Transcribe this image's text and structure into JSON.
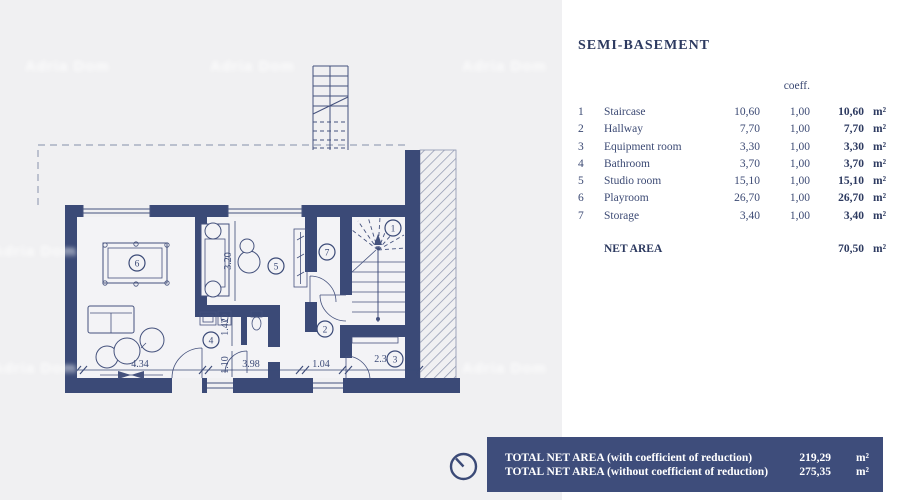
{
  "window": {
    "background_left": "#f0f0f2",
    "background_right": "#ffffff"
  },
  "header": {
    "title": "SEMI-BASEMENT"
  },
  "table": {
    "coeff_header": "coeff.",
    "rows": [
      {
        "num": "1",
        "name": "Staircase",
        "area": "10,60",
        "coeff": "1,00",
        "total": "10,60",
        "unit": "m²"
      },
      {
        "num": "2",
        "name": "Hallway",
        "area": "7,70",
        "coeff": "1,00",
        "total": "7,70",
        "unit": "m²"
      },
      {
        "num": "3",
        "name": "Equipment room",
        "area": "3,30",
        "coeff": "1,00",
        "total": "3,30",
        "unit": "m²"
      },
      {
        "num": "4",
        "name": "Bathroom",
        "area": "3,70",
        "coeff": "1,00",
        "total": "3,70",
        "unit": "m²"
      },
      {
        "num": "5",
        "name": "Studio room",
        "area": "15,10",
        "coeff": "1,00",
        "total": "15,10",
        "unit": "m²"
      },
      {
        "num": "6",
        "name": "Playroom",
        "area": "26,70",
        "coeff": "1,00",
        "total": "26,70",
        "unit": "m²"
      },
      {
        "num": "7",
        "name": "Storage",
        "area": "3,40",
        "coeff": "1,00",
        "total": "3,40",
        "unit": "m²"
      }
    ],
    "net_area": {
      "label": "NET AREA",
      "value": "70,50",
      "unit": "m²"
    }
  },
  "summary_banner": {
    "background": "#3e4d7b",
    "line1": {
      "label": "TOTAL NET AREA (with coefficient of reduction)",
      "value": "219,29",
      "unit": "m²"
    },
    "line2": {
      "label": "TOTAL NET AREA (without coefficient of reduction)",
      "value": "275,35",
      "unit": "m²"
    }
  },
  "floor_plan": {
    "wall_color": "#3b4a77",
    "room_numbers": [
      "1",
      "2",
      "3",
      "4",
      "5",
      "6",
      "7"
    ],
    "dims_bottom": [
      "4.34",
      "3.98",
      "1.04",
      "2.39"
    ],
    "dims_vertical": [
      "3.20",
      "1.42",
      "1.10"
    ]
  },
  "watermark": {
    "text": "Adria Dom"
  },
  "icons": {
    "clock": "clock-icon"
  }
}
